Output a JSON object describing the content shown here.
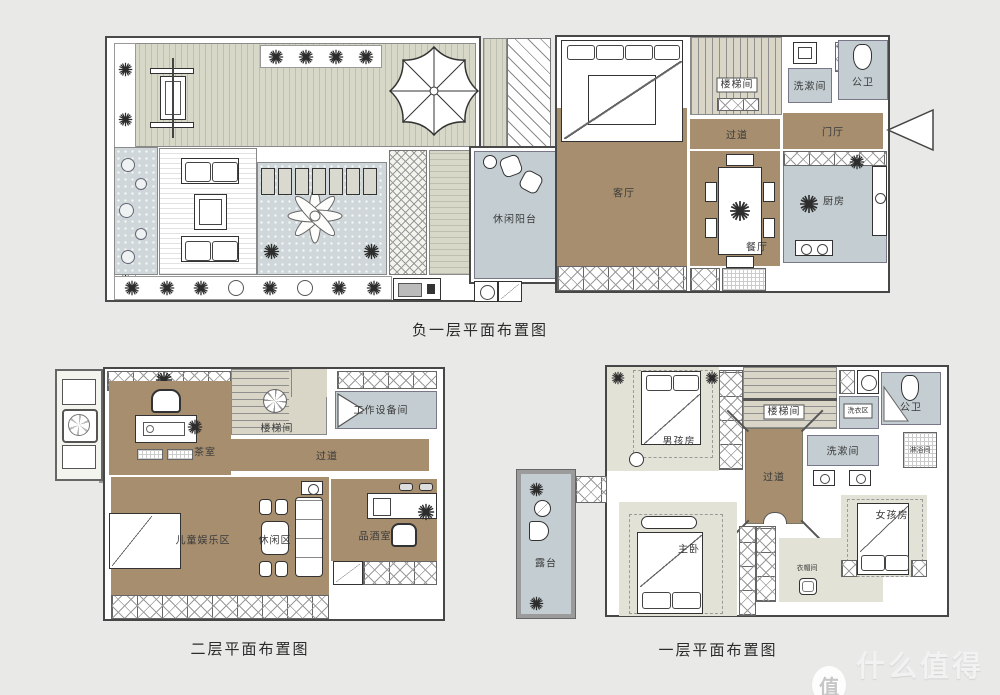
{
  "page": {
    "background": "#e9eae7"
  },
  "plans": [
    {
      "title": "负一层平面布置图",
      "rooms": {
        "leisure_balcony": "休闲阳台",
        "living_room": "客厅",
        "stairwell": "楼梯间",
        "washroom": "洗漱间",
        "public_bath": "公卫",
        "corridor": "过道",
        "foyer": "门厅",
        "dining_room": "餐厅",
        "kitchen": "厨房"
      }
    },
    {
      "title": "二层平面布置图",
      "rooms": {
        "tea_room": "茶室",
        "stairwell": "楼梯间",
        "equipment_room": "工作设备间",
        "corridor": "过道",
        "kids_area": "儿童娱乐区",
        "lounge": "休闲区",
        "wine_room": "品酒室"
      }
    },
    {
      "title": "一层平面布置图",
      "rooms": {
        "boys_room": "男孩房",
        "stairwell": "楼梯间",
        "laundry": "洗衣区",
        "public_bath": "公卫",
        "washroom": "洗漱间",
        "shower": "淋浴间",
        "corridor": "过道",
        "terrace": "露台",
        "master_bedroom": "主卧",
        "cloakroom": "衣帽间",
        "girls_room": "女孩房"
      }
    }
  ],
  "watermark": {
    "badge": "值",
    "text": "什么值得买"
  },
  "colors": {
    "room_brown": "#a68e6e",
    "room_blue": "#c4ced2",
    "room_beige": "#e2e2d7",
    "stair_beige": "#d9d6c8",
    "background": "#e9eae7",
    "wall": "#474747"
  }
}
